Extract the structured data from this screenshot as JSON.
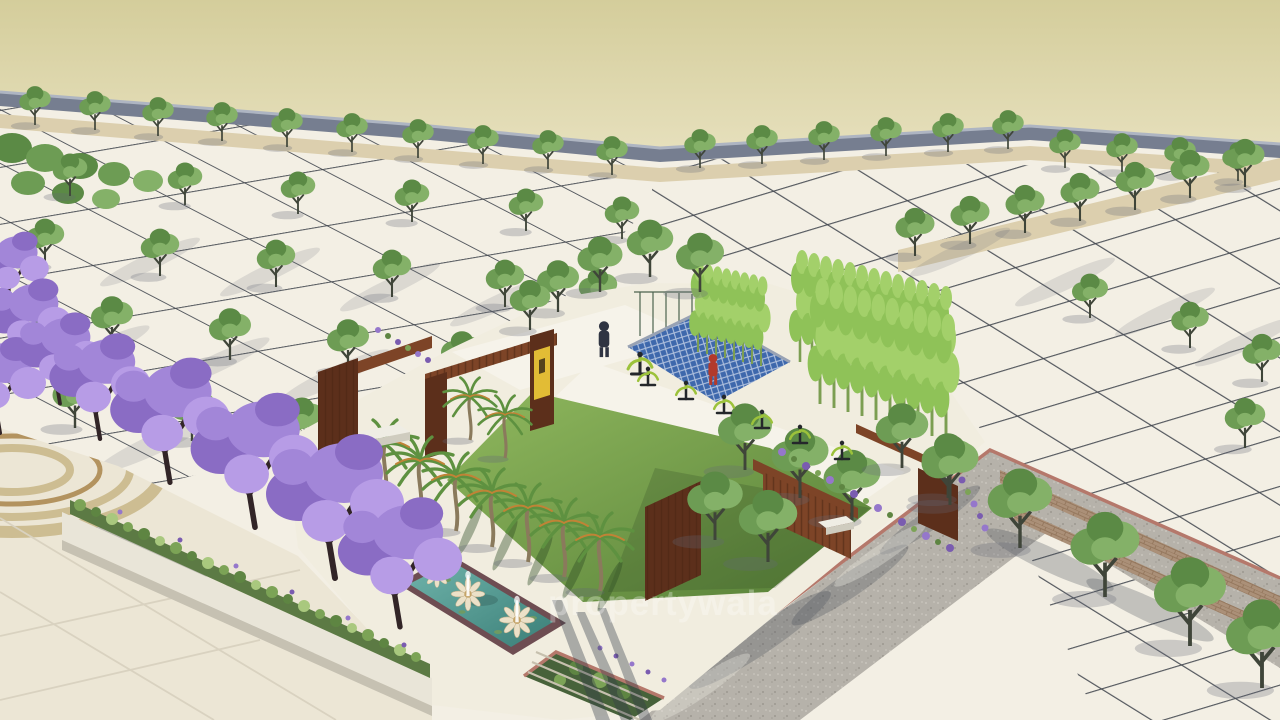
{
  "scene": {
    "watermark": {
      "text": "propertywala"
    }
  },
  "palette": {
    "sky-top": "#d4cd9b",
    "sky-bottom": "#f2ecd2",
    "wall": "#767e90",
    "wall-top": "#aeb5c2",
    "plot": "#f3efe4",
    "park": "#f1eddf",
    "path": "#f6f3ea",
    "grid": "#41454e",
    "tan": "#dccfae",
    "g1": "#6d9c54",
    "g2": "#84b168",
    "g3": "#5b8a45",
    "trunk": "#3f4539",
    "cyp": "#4e7a3c",
    "bam1": "#8fc258",
    "bam2": "#a3d06a",
    "bamst": "#7c9e52",
    "palm-trunk": "#8a7a5c",
    "frond": "#5e9140",
    "frond-accent": "#c08336",
    "lawn-light": "#90b85e",
    "lawn-dark": "#567f37",
    "corten": "#7d4427",
    "corten-dark": "#5c2f1b",
    "slat": "#4a2514",
    "sign-yellow": "#e2bc35",
    "sign-glyph": "#55431c",
    "lattice-blue": "#3e68ac",
    "lattice-line": "#d7dfee",
    "lattice-frame": "#98a2b4",
    "fence": "#2f4a35",
    "water-light": "#6fb3aa",
    "water-dark": "#3b7f78",
    "pool-edge": "#6e4d52",
    "petal": "#ece1c8",
    "lotus-center": "#c5a468",
    "p1": "#a286d8",
    "p2": "#8a6cc4",
    "p3": "#b79ce6",
    "branch": "#322527",
    "shrub1": "#7ca356",
    "shrub2": "#5e8542",
    "shrub3": "#a9c87e",
    "lav1": "#9577cb",
    "lav2": "#7a5cb0",
    "planter-face": "#e9e5d8",
    "planter-side": "#c6c1b2",
    "soil": "#5c7a44",
    "road": "#b6b2aa",
    "road-speck-light": "#c9c5bd",
    "road-speck-dark": "#a09c94",
    "paver": "#ab9078",
    "paver-line": "#907257",
    "curb": "#b5786b",
    "bench-top": "#efede4",
    "bench-side": "#cfccbf",
    "eq-dark": "#24272b",
    "eq-green": "#9cc23b",
    "person-dark": "#2f3442",
    "person-red": "#b23a2c",
    "plaza": "#ece6d5",
    "ring1": "#cdbd92",
    "ring2": "#b3935f",
    "joint": "#d9d2c0",
    "step-line": "#c6c0ae",
    "watermark-color": "rgba(255,255,255,0.30)"
  }
}
